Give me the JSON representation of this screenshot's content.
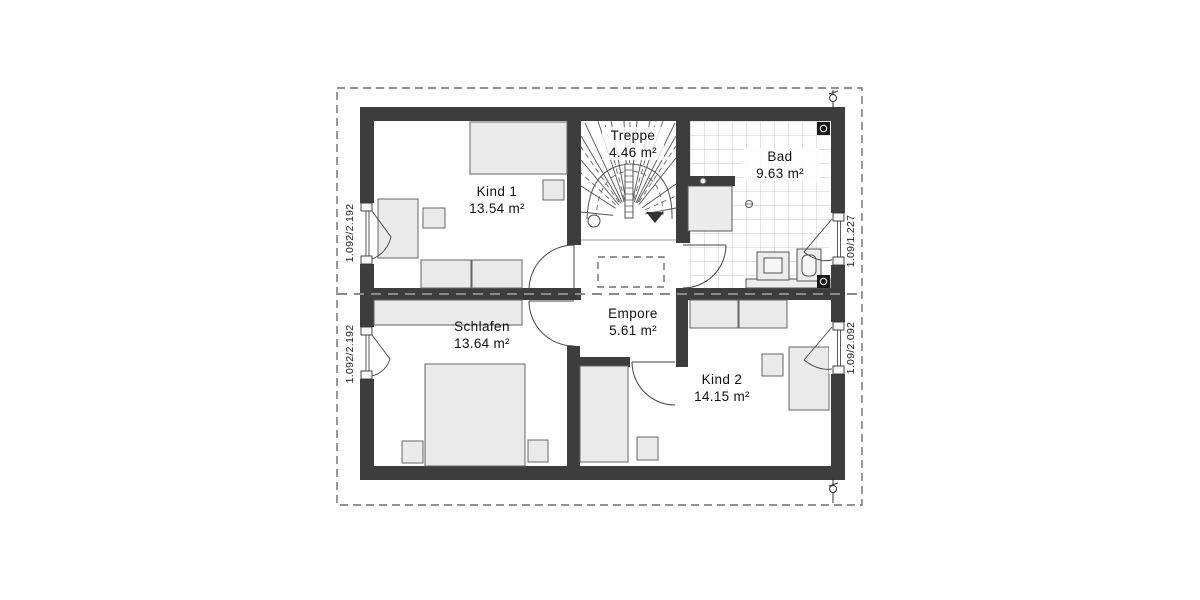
{
  "rooms": {
    "kind1": {
      "name": "Kind 1",
      "area": "13.54 m²"
    },
    "treppe": {
      "name": "Treppe",
      "area": "4.46 m²"
    },
    "bad": {
      "name": "Bad",
      "area": "9.63 m²"
    },
    "schlafen": {
      "name": "Schlafen",
      "area": "13.64 m²"
    },
    "empore": {
      "name": "Empore",
      "area": "5.61 m²"
    },
    "kind2": {
      "name": "Kind 2",
      "area": "14.15 m²"
    }
  },
  "windows": {
    "left_top": "1.092/2.192",
    "left_bottom": "1.092/2.192",
    "right_top": "1.09/1.227",
    "right_bottom": "1.09/2.092"
  },
  "colors": {
    "wall": "#3d3d3d",
    "furniture_fill": "#eaeaea",
    "tile_line": "#c9c9c9",
    "boundary_dash": "#6e6e6e",
    "section_line": "#8a8a8a"
  }
}
